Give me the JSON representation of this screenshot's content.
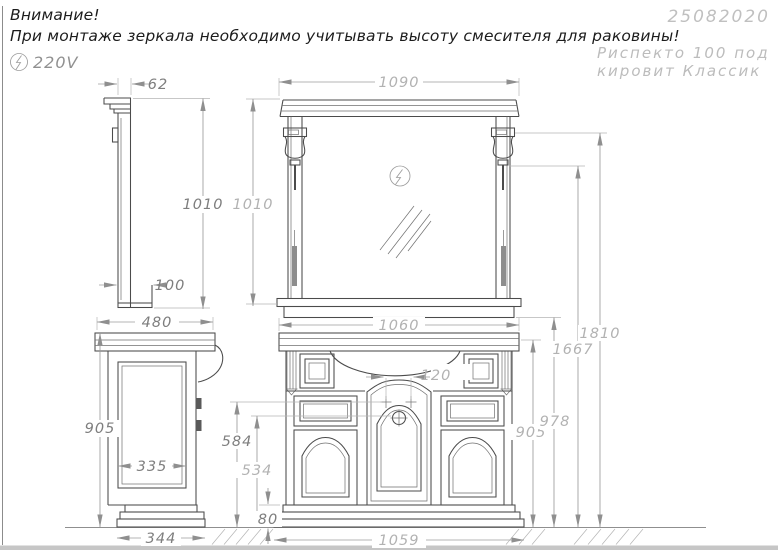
{
  "header": {
    "warning_line1": "Внимание!",
    "warning_line2": "При монтаже зеркала необходимо учитывать высоту смесителя для раковины!",
    "voltage": "220V",
    "doc_number": "25082020",
    "model_line1": "Риспекто 100 под",
    "model_line2": "кировит Классик"
  },
  "dims": {
    "crown_depth": "62",
    "mirror_height_side": "1010",
    "shelf_depth": "100",
    "mirror_width": "1090",
    "mirror_height": "1010",
    "cabinet_depth": "480",
    "cabinet_height": "905",
    "side_panel": "335",
    "base_depth": "344",
    "cabinet_width": "1060",
    "faucet_spacing": "120",
    "faucet_height": "584",
    "drain_height": "534",
    "plinth_height": "80",
    "base_width": "1059",
    "countertop_height": "905",
    "mirror_bottom": "978",
    "lamp_bottom": "1667",
    "lamp_top": "1810"
  },
  "colors": {
    "object_line": "#4b4b4b",
    "dim_line": "#9c9c9c",
    "dim_text_dark": "#7e7e7e",
    "dim_text_light": "#b2b2b2",
    "header_text": "#1c1c1c",
    "muted_text": "#bcbcbc",
    "ground_hatch": "#b5b5b5"
  },
  "icons": {
    "electric": "circled lightning bolt",
    "mirror_glass": "diagonal hatch"
  }
}
